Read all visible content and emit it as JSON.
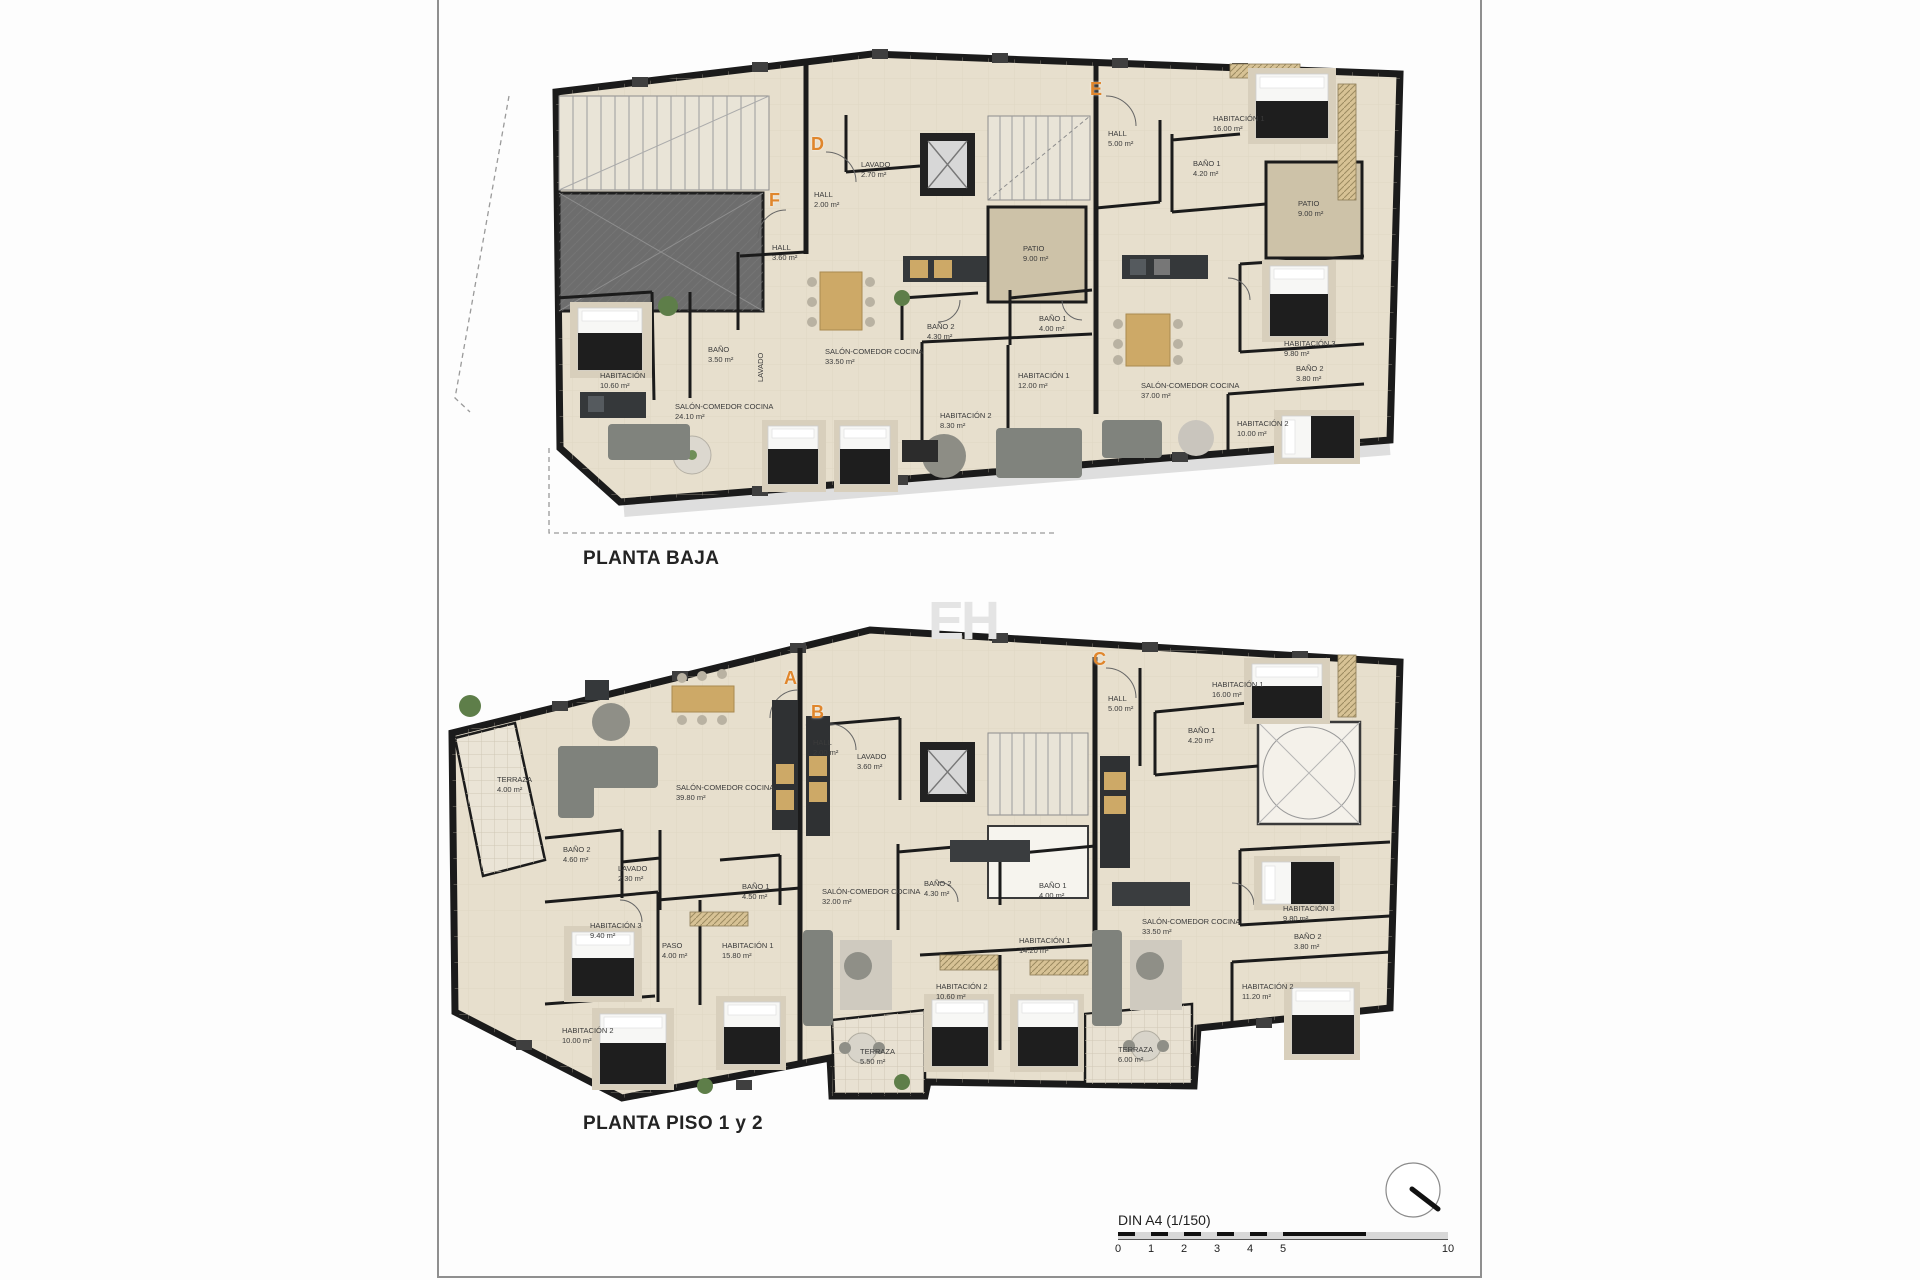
{
  "sheet": {
    "watermark": "EH",
    "scale_bar": {
      "label": "DIN A4 (1/150)",
      "ticks": [
        {
          "t": "0",
          "u": 0
        },
        {
          "t": "1",
          "u": 1
        },
        {
          "t": "2",
          "u": 2
        },
        {
          "t": "3",
          "u": 3
        },
        {
          "t": "4",
          "u": 4
        },
        {
          "t": "5",
          "u": 5
        },
        {
          "t": "10",
          "u": 10
        }
      ]
    }
  },
  "colors": {
    "accent_orange": "#e0862c",
    "wall": "#1b1b1b",
    "floor": "#e7dfcd",
    "patio": "#cdc2a8",
    "ramp": "#6d6d6d",
    "label_text": "#3b3b3b"
  },
  "plans": [
    {
      "title": "PLANTA BAJA",
      "title_x": 583,
      "title_y": 548,
      "units": [
        {
          "letter": "D",
          "x": 811,
          "y": 134
        },
        {
          "letter": "E",
          "x": 1090,
          "y": 79
        },
        {
          "letter": "F",
          "x": 769,
          "y": 190
        }
      ],
      "rooms": [
        {
          "name": "HALL",
          "area": "2.00 m²",
          "x": 814,
          "y": 190
        },
        {
          "name": "LAVADO",
          "area": "2.70 m²",
          "x": 861,
          "y": 160
        },
        {
          "name": "HALL",
          "area": "3.60 m²",
          "x": 772,
          "y": 243
        },
        {
          "name": "HABITACIÓN",
          "area": "10.60 m²",
          "x": 600,
          "y": 371
        },
        {
          "name": "BAÑO",
          "area": "3.50 m²",
          "x": 708,
          "y": 345
        },
        {
          "name": "LAVADO",
          "area": "",
          "x": 756,
          "y": 382,
          "rot": -90
        },
        {
          "name": "SALÓN-COMEDOR COCINA",
          "area": "24.10 m²",
          "x": 675,
          "y": 402
        },
        {
          "name": "PATIO",
          "area": "9.00 m²",
          "x": 1023,
          "y": 244
        },
        {
          "name": "BAÑO 2",
          "area": "4.30 m²",
          "x": 927,
          "y": 322
        },
        {
          "name": "BAÑO 1",
          "area": "4.00 m²",
          "x": 1039,
          "y": 314
        },
        {
          "name": "SALÓN-COMEDOR COCINA",
          "area": "33.50 m²",
          "x": 825,
          "y": 347
        },
        {
          "name": "HABITACIÓN 1",
          "area": "12.00 m²",
          "x": 1018,
          "y": 371
        },
        {
          "name": "HABITACIÓN 2",
          "area": "8.30 m²",
          "x": 940,
          "y": 411
        },
        {
          "name": "HALL",
          "area": "5.00 m²",
          "x": 1108,
          "y": 129
        },
        {
          "name": "HABITACIÓN 1",
          "area": "16.00 m²",
          "x": 1213,
          "y": 114
        },
        {
          "name": "BAÑO 1",
          "area": "4.20 m²",
          "x": 1193,
          "y": 159
        },
        {
          "name": "PATIO",
          "area": "9.00 m²",
          "x": 1298,
          "y": 199
        },
        {
          "name": "HABITACIÓN 3",
          "area": "9.80 m²",
          "x": 1284,
          "y": 339
        },
        {
          "name": "BAÑO 2",
          "area": "3.80 m²",
          "x": 1296,
          "y": 364
        },
        {
          "name": "SALÓN-COMEDOR COCINA",
          "area": "37.00 m²",
          "x": 1141,
          "y": 381
        },
        {
          "name": "HABITACIÓN 2",
          "area": "10.00 m²",
          "x": 1237,
          "y": 419
        }
      ]
    },
    {
      "title": "PLANTA PISO 1 y 2",
      "title_x": 583,
      "title_y": 1113,
      "units": [
        {
          "letter": "A",
          "x": 784,
          "y": 668
        },
        {
          "letter": "B",
          "x": 811,
          "y": 702
        },
        {
          "letter": "C",
          "x": 1093,
          "y": 649
        }
      ],
      "rooms": [
        {
          "name": "TERRAZA",
          "area": "4.00 m²",
          "x": 497,
          "y": 775
        },
        {
          "name": "SALÓN-COMEDOR COCINA",
          "area": "39.80 m²",
          "x": 676,
          "y": 783
        },
        {
          "name": "BAÑO 2",
          "area": "4.60 m²",
          "x": 563,
          "y": 845
        },
        {
          "name": "LAVADO",
          "area": "2.30 m²",
          "x": 618,
          "y": 864
        },
        {
          "name": "BAÑO 1",
          "area": "4.50 m²",
          "x": 742,
          "y": 882
        },
        {
          "name": "HABITACIÓN 3",
          "area": "9.40 m²",
          "x": 590,
          "y": 921
        },
        {
          "name": "PASO",
          "area": "4.00 m²",
          "x": 662,
          "y": 941
        },
        {
          "name": "HABITACIÓN 1",
          "area": "15.80 m²",
          "x": 722,
          "y": 941
        },
        {
          "name": "HABITACIÓN 2",
          "area": "10.00 m²",
          "x": 562,
          "y": 1026
        },
        {
          "name": "HALL",
          "area": "2.00 m²",
          "x": 813,
          "y": 738
        },
        {
          "name": "LAVADO",
          "area": "3.60 m²",
          "x": 857,
          "y": 752
        },
        {
          "name": "SALÓN-COMEDOR COCINA",
          "area": "32.00 m²",
          "x": 822,
          "y": 887
        },
        {
          "name": "BAÑO 2",
          "area": "4.30 m²",
          "x": 924,
          "y": 879
        },
        {
          "name": "BAÑO 1",
          "area": "4.00 m²",
          "x": 1039,
          "y": 881
        },
        {
          "name": "HABITACIÓN 1",
          "area": "14.20 m²",
          "x": 1019,
          "y": 936
        },
        {
          "name": "HABITACIÓN 2",
          "area": "10.60 m²",
          "x": 936,
          "y": 982
        },
        {
          "name": "TERRAZA",
          "area": "5.50 m²",
          "x": 860,
          "y": 1047
        },
        {
          "name": "HALL",
          "area": "5.00 m²",
          "x": 1108,
          "y": 694
        },
        {
          "name": "HABITACIÓN 1",
          "area": "16.00 m²",
          "x": 1212,
          "y": 680
        },
        {
          "name": "BAÑO 1",
          "area": "4.20 m²",
          "x": 1188,
          "y": 726
        },
        {
          "name": "SALÓN-COMEDOR COCINA",
          "area": "33.50 m²",
          "x": 1142,
          "y": 917
        },
        {
          "name": "HABITACIÓN 3",
          "area": "9.80 m²",
          "x": 1283,
          "y": 904
        },
        {
          "name": "BAÑO 2",
          "area": "3.80 m²",
          "x": 1294,
          "y": 932
        },
        {
          "name": "HABITACIÓN 2",
          "area": "11.20 m²",
          "x": 1242,
          "y": 982
        },
        {
          "name": "TERRAZA",
          "area": "6.00 m²",
          "x": 1118,
          "y": 1045
        }
      ]
    }
  ]
}
